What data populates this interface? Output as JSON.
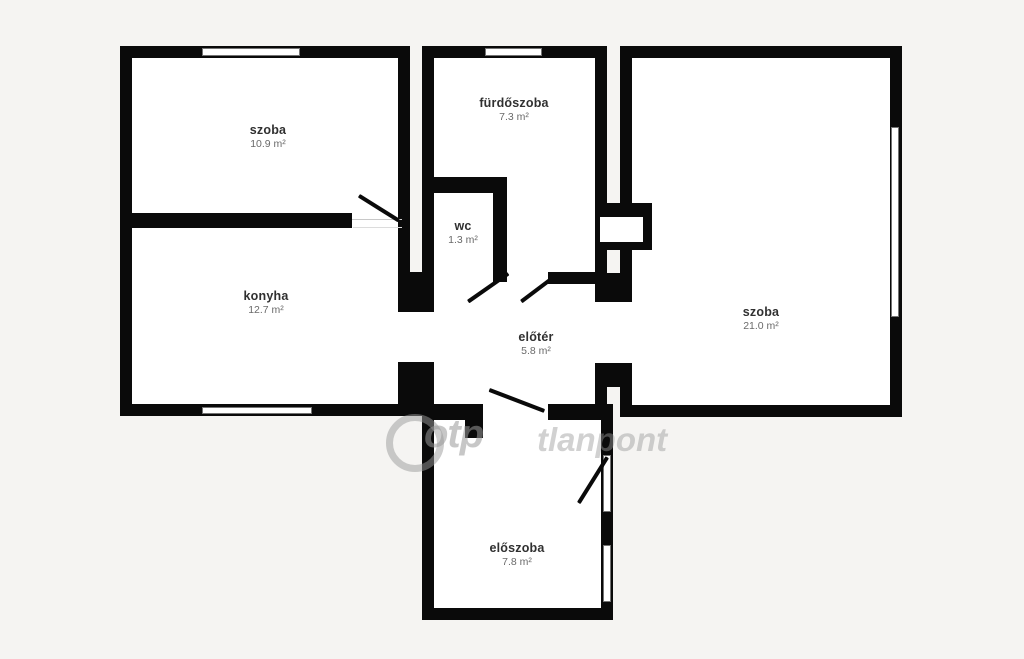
{
  "plan": {
    "title": "apartment floor plan",
    "rooms": [
      {
        "id": "szoba-1",
        "name": "szoba",
        "area": "10.9 m²"
      },
      {
        "id": "furdoszoba",
        "name": "fürdőszoba",
        "area": "7.3 m²"
      },
      {
        "id": "wc",
        "name": "wc",
        "area": "1.3 m²"
      },
      {
        "id": "konyha",
        "name": "konyha",
        "area": "12.7 m²"
      },
      {
        "id": "eloter",
        "name": "előtér",
        "area": "5.8 m²"
      },
      {
        "id": "szoba-2",
        "name": "szoba",
        "area": "21.0 m²"
      },
      {
        "id": "eloszoba",
        "name": "előszoba",
        "area": "7.8 m²"
      }
    ],
    "watermark": {
      "logo": "otp-circle-logo",
      "text_left": "otp",
      "text_right": "tlanpont"
    },
    "colors": {
      "wall": "#0a0a0a",
      "floor": "#ffffff",
      "background": "#f5f4f2",
      "watermark": "#9a9a9a",
      "label": "#303030",
      "area_text": "#6a6a6a"
    }
  }
}
